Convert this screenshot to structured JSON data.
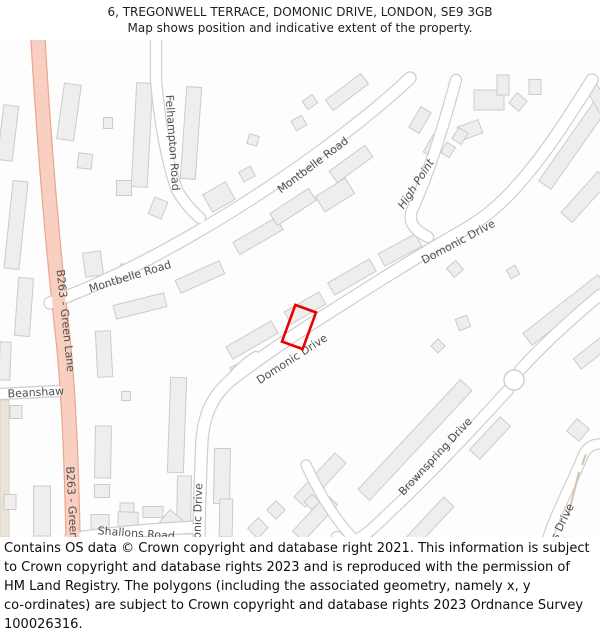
{
  "header": {
    "line1": "6, TREGONWELL TERRACE, DOMONIC DRIVE, LONDON, SE9 3GB",
    "line2": "Map shows position and indicative extent of the property."
  },
  "footer": {
    "lines": [
      "Contains OS data © Crown copyright and database right 2021. This information is subject",
      "to Crown copyright and database rights 2023 and is reproduced with the permission of",
      "HM Land Registry. The polygons (including the associated geometry, namely x, y",
      "co-ordinates) are subject to Crown copyright and database rights 2023 Ordnance Survey",
      "100026316."
    ]
  },
  "map": {
    "colors": {
      "background": "#fdfdfd",
      "building_fill": "#efeeed",
      "building_stroke": "#cccbca",
      "road_casing": "#cfcecd",
      "road_fill": "#ffffff",
      "b_road_fill": "#f8cfc0",
      "b_road_casing": "#e9a78d",
      "label": "#4f4f4f",
      "plot_outline": "#ec0000",
      "beige_fill": "#eae4d9",
      "beige_stroke": "#d9d2c5",
      "path_edge": "#d6c3ae"
    },
    "labels": [
      {
        "name": "b263-green-lane-upper",
        "text": "B263 - Green Lane",
        "x": 62,
        "y": 281,
        "rot": 84,
        "italic": false
      },
      {
        "name": "b263-green-lane-lower",
        "text": "B263 - Green Lane",
        "x": 69,
        "y": 478,
        "rot": 87,
        "italic": false
      },
      {
        "name": "beanshaw",
        "text": "Beanshaw",
        "x": 36,
        "y": 356,
        "rot": -3,
        "italic": false
      },
      {
        "name": "shallons-road",
        "text": "Shallons Road",
        "x": 136,
        "y": 497,
        "rot": 4,
        "italic": false
      },
      {
        "name": "felhampton-road",
        "text": "Felhampton Road",
        "x": 169,
        "y": 103,
        "rot": 86,
        "italic": false
      },
      {
        "name": "montbelle-road-upper",
        "text": "Montbelle Road",
        "x": 315,
        "y": 128,
        "rot": -37,
        "italic": false
      },
      {
        "name": "montbelle-road-lower",
        "text": "Montbelle Road",
        "x": 131,
        "y": 240,
        "rot": -17,
        "italic": false
      },
      {
        "name": "high-point",
        "text": "High Point",
        "x": 419,
        "y": 146,
        "rot": -57,
        "italic": true
      },
      {
        "name": "domonic-drive-upper",
        "text": "Domonic Drive",
        "x": 460,
        "y": 205,
        "rot": -28,
        "italic": false
      },
      {
        "name": "domonic-drive-mid",
        "text": "Domonic Drive",
        "x": 294,
        "y": 322,
        "rot": -33,
        "italic": false
      },
      {
        "name": "domonic-drive-south",
        "text": "Domonic Drive",
        "x": 201,
        "y": 484,
        "rot": -88,
        "italic": false
      },
      {
        "name": "brownspring-drive",
        "text": "Brownspring Drive",
        "x": 438,
        "y": 419,
        "rot": -47,
        "italic": false
      },
      {
        "name": "slades-drive",
        "text": "Slades Drive",
        "x": 559,
        "y": 497,
        "rot": -64,
        "italic": false
      }
    ],
    "roads": [
      {
        "name": "beanshaw-road",
        "d": "M 0,354 L 58,351",
        "w": 10,
        "b": false
      },
      {
        "name": "shallons-road",
        "d": "M 70,499 C 115,492 160,489 197,487",
        "w": 11,
        "b": false
      },
      {
        "name": "montbelle-road",
        "d": "M 50,263 C 140,230 240,170 318,113 C 352,88 385,62 410,38",
        "w": 11,
        "b": false
      },
      {
        "name": "felhampton-road",
        "d": "M 156,0 L 156,40 C 160,85 167,122 177,150 C 183,161 191,170 200,178",
        "w": 10,
        "b": false
      },
      {
        "name": "high-point",
        "d": "M 456,40 C 443,88 429,133 413,168 C 407,180 413,190 428,197",
        "w": 10,
        "b": false
      },
      {
        "name": "domonic-drive",
        "d": "M 592,40 C 570,75 545,115 515,148 C 495,170 478,182 462,191 C 430,209 380,240 330,272 C 290,297 260,318 231,340 C 212,356 204,375 202,400 C 200,440 199,490 199,497",
        "w": 11,
        "b": false
      },
      {
        "name": "domonic-drive-stub",
        "d": "M 228,342 C 237,330 246,322 256,316",
        "w": 8,
        "b": false
      },
      {
        "name": "brownspring-drive-ne",
        "d": "M 600,255 C 570,280 540,308 520,330",
        "w": 10,
        "b": false
      },
      {
        "name": "brownspring-drive-sw",
        "d": "M 508,350 C 470,392 430,434 390,472 C 370,491 350,512 337,497",
        "w": 10,
        "b": false
      },
      {
        "name": "cross-street",
        "d": "M 306,425 C 320,455 336,480 352,497",
        "w": 9,
        "b": false
      },
      {
        "name": "slades-drive",
        "d": "M 548,497 C 557,470 570,447 582,418 C 586,407 593,404 600,404",
        "w": 9,
        "b": false
      },
      {
        "name": "b263-green-lane",
        "d": "M 38,0 C 44,100 52,200 62,290 C 70,360 72,450 73,497",
        "w": 13,
        "b": true
      }
    ],
    "roundabout": {
      "x": 514,
      "y": 340,
      "r": 10
    },
    "path_edges": [
      "M 568,476 L 579,432",
      "M 582,425 L 586,414"
    ],
    "beige_area": {
      "x": 0,
      "y": 360,
      "w": 9,
      "h": 137
    },
    "buildings": [
      [
        8,
        93,
        15,
        55,
        7
      ],
      [
        16,
        185,
        15,
        88,
        6
      ],
      [
        24,
        267,
        15,
        58,
        4
      ],
      [
        5,
        321,
        11,
        38,
        2
      ],
      [
        104,
        314,
        15,
        46,
        -3
      ],
      [
        42,
        471,
        17,
        50,
        0
      ],
      [
        10,
        462,
        12,
        15,
        0
      ],
      [
        16,
        372,
        12,
        13,
        0
      ],
      [
        69,
        72,
        17,
        56,
        8
      ],
      [
        85,
        121,
        14,
        15,
        6
      ],
      [
        108,
        83,
        9,
        11,
        0
      ],
      [
        142,
        95,
        16,
        104,
        3
      ],
      [
        124,
        148,
        15,
        15,
        0
      ],
      [
        158,
        168,
        14,
        18,
        22
      ],
      [
        191,
        93,
        15,
        92,
        4
      ],
      [
        124,
        228,
        7,
        8,
        0
      ],
      [
        140,
        266,
        52,
        14,
        -14
      ],
      [
        200,
        237,
        48,
        14,
        -24
      ],
      [
        258,
        196,
        50,
        14,
        -30
      ],
      [
        293,
        167,
        46,
        14,
        -33
      ],
      [
        351,
        124,
        44,
        14,
        -36
      ],
      [
        93,
        224,
        18,
        24,
        -8
      ],
      [
        219,
        157,
        26,
        20,
        -30
      ],
      [
        247,
        134,
        13,
        11,
        -28
      ],
      [
        253,
        100,
        10,
        10,
        15
      ],
      [
        299,
        83,
        12,
        11,
        -30
      ],
      [
        347,
        52,
        44,
        13,
        -37
      ],
      [
        310,
        62,
        12,
        10,
        -35
      ],
      [
        420,
        80,
        24,
        12,
        -60
      ],
      [
        433,
        106,
        20,
        11,
        -60
      ],
      [
        489,
        60,
        30,
        20,
        0
      ],
      [
        503,
        45,
        12,
        20,
        0
      ],
      [
        518,
        62,
        13,
        13,
        40
      ],
      [
        535,
        47,
        12,
        15,
        0
      ],
      [
        470,
        90,
        22,
        14,
        -20
      ],
      [
        575,
        102,
        105,
        15,
        -55
      ],
      [
        585,
        157,
        55,
        15,
        -48
      ],
      [
        565,
        270,
        95,
        15,
        -38
      ],
      [
        599,
        307,
        55,
        13,
        -38
      ],
      [
        252,
        300,
        52,
        14,
        -30
      ],
      [
        305,
        268,
        40,
        14,
        -30
      ],
      [
        352,
        237,
        48,
        14,
        -30
      ],
      [
        400,
        210,
        42,
        14,
        -28
      ],
      [
        455,
        229,
        12,
        12,
        -40
      ],
      [
        463,
        283,
        12,
        12,
        -20
      ],
      [
        438,
        306,
        10,
        10,
        -45
      ],
      [
        513,
        232,
        10,
        10,
        -30
      ],
      [
        177,
        385,
        16,
        95,
        2
      ],
      [
        184,
        465,
        14,
        58,
        1
      ],
      [
        222,
        436,
        16,
        55,
        1
      ],
      [
        226,
        478,
        13,
        38,
        1
      ],
      [
        103,
        412,
        16,
        52,
        1
      ],
      [
        102,
        451,
        15,
        13,
        0
      ],
      [
        127,
        468,
        14,
        10,
        0
      ],
      [
        153,
        472,
        20,
        11,
        0
      ],
      [
        100,
        482,
        18,
        15,
        0
      ],
      [
        128,
        480,
        20,
        16,
        2
      ],
      [
        171,
        481,
        16,
        16,
        40
      ],
      [
        126,
        356,
        9,
        9,
        0
      ],
      [
        320,
        440,
        60,
        15,
        -47
      ],
      [
        315,
        478,
        50,
        15,
        -47
      ],
      [
        415,
        400,
        150,
        16,
        -47
      ],
      [
        490,
        398,
        45,
        14,
        -47
      ],
      [
        578,
        390,
        16,
        16,
        40
      ],
      [
        430,
        482,
        55,
        14,
        -47
      ],
      [
        276,
        470,
        13,
        13,
        -45
      ],
      [
        258,
        488,
        15,
        14,
        -45
      ],
      [
        312,
        462,
        11,
        11,
        -45
      ],
      [
        460,
        96,
        13,
        11,
        -58
      ],
      [
        448,
        110,
        12,
        10,
        -58
      ],
      [
        335,
        155,
        35,
        18,
        -32
      ],
      [
        240,
        330,
        16,
        13,
        -25
      ],
      [
        598,
        58,
        12,
        28,
        -30
      ]
    ],
    "plot": {
      "x": 299,
      "y": 287,
      "w": 22,
      "h": 39,
      "rot": 20,
      "stroke_w": 2.6
    }
  }
}
